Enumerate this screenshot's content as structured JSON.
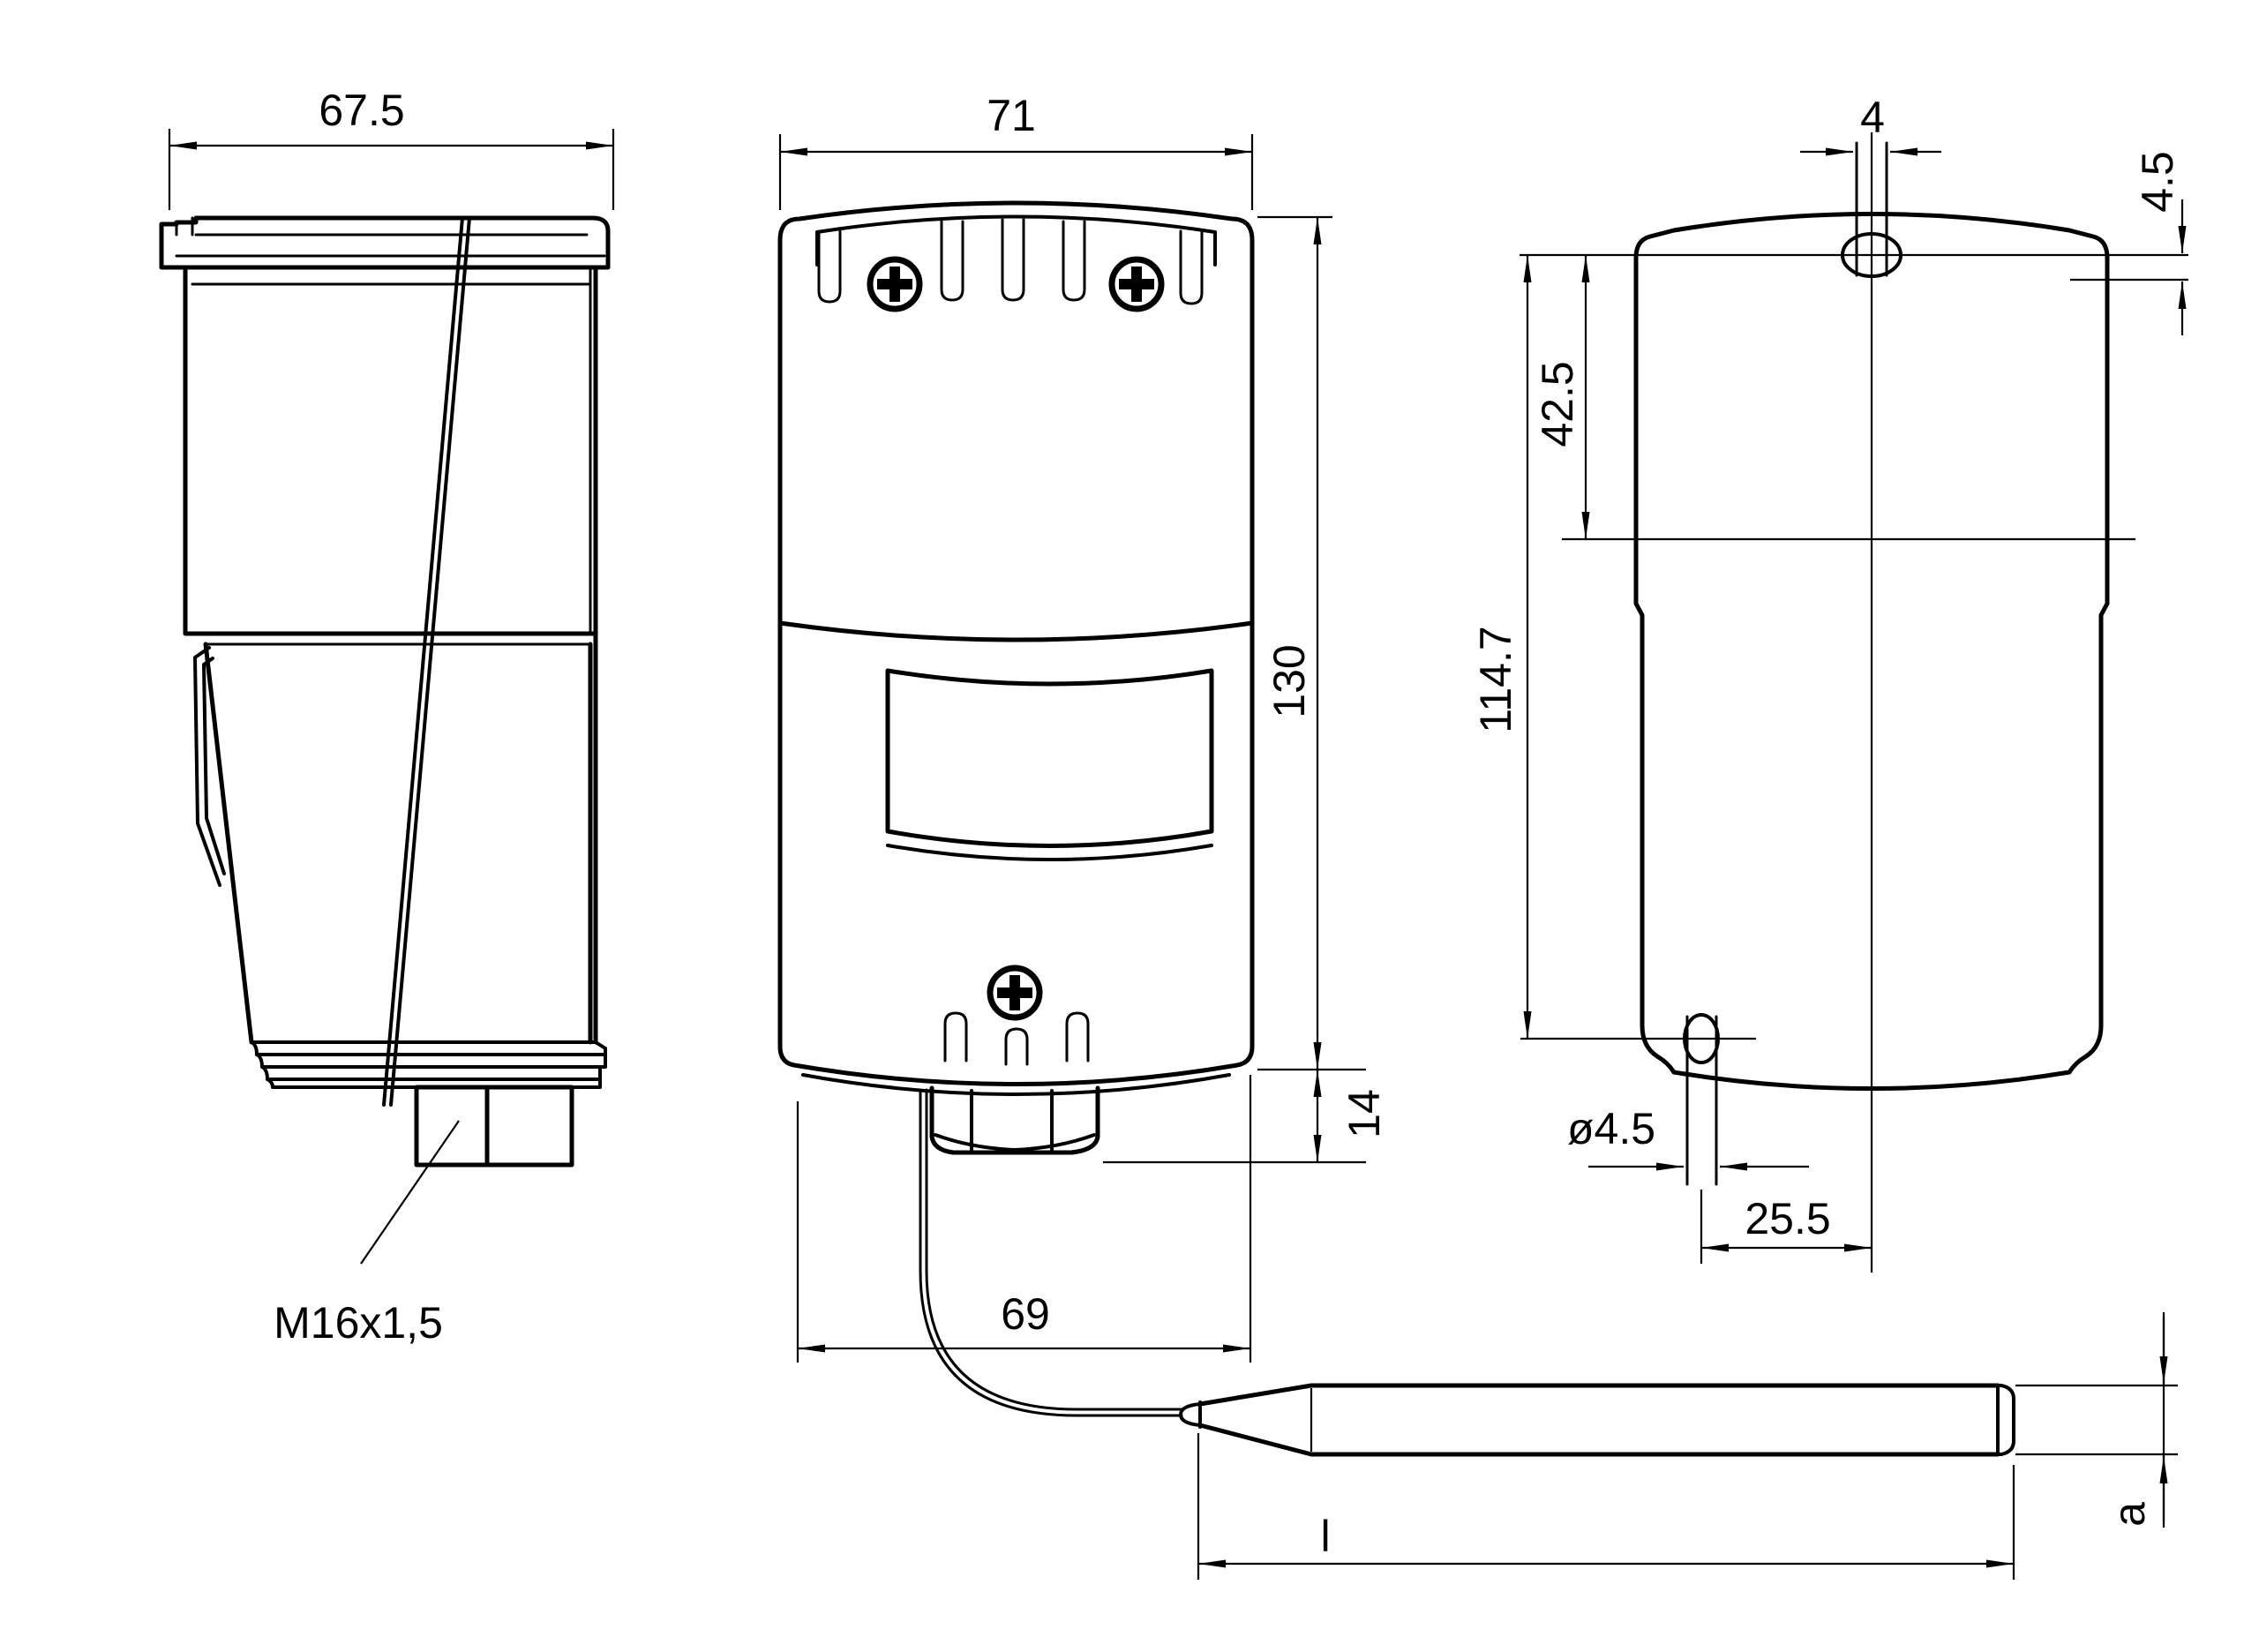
{
  "drawing": {
    "type": "technical-dimension-drawing",
    "part": "thermostat with capillary sensor probe",
    "colors": {
      "line": "#000000",
      "background": "#ffffff"
    },
    "labels": {
      "side_width": "67.5",
      "gland": "M16x1,5",
      "front_width": "71",
      "front_height": "130",
      "nut_height": "14",
      "base_width": "69",
      "slot_width": "4",
      "step_depth": "4.5",
      "hole_offset": "42.5",
      "hole_pitch": "114.7",
      "hole_dia": "ø4.5",
      "hole_off_center": "25.5",
      "probe_length": "l",
      "probe_dia": "a"
    }
  }
}
